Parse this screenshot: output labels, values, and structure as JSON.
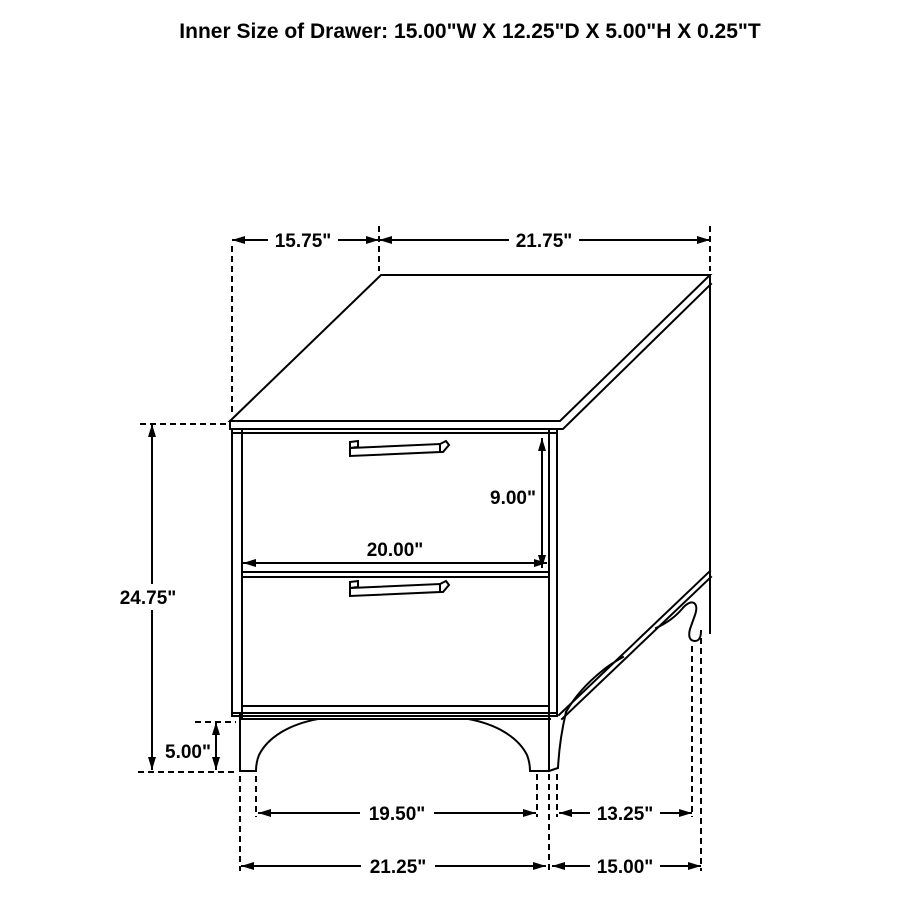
{
  "title": "Inner Size of Drawer: 15.00\"W X 12.25\"D X 5.00\"H X 0.25\"T",
  "colors": {
    "ink": "#000000",
    "background": "#ffffff"
  },
  "dims": {
    "top_depth": "15.75\"",
    "top_width": "21.75\"",
    "drawer_opening_height": "9.00\"",
    "drawer_opening_width": "20.00\"",
    "overall_height": "24.75\"",
    "leg_height": "5.00\"",
    "front_leg_spacing": "19.50\"",
    "side_leg_spacing": "13.25\"",
    "overall_width": "21.25\"",
    "overall_depth": "15.00\""
  }
}
